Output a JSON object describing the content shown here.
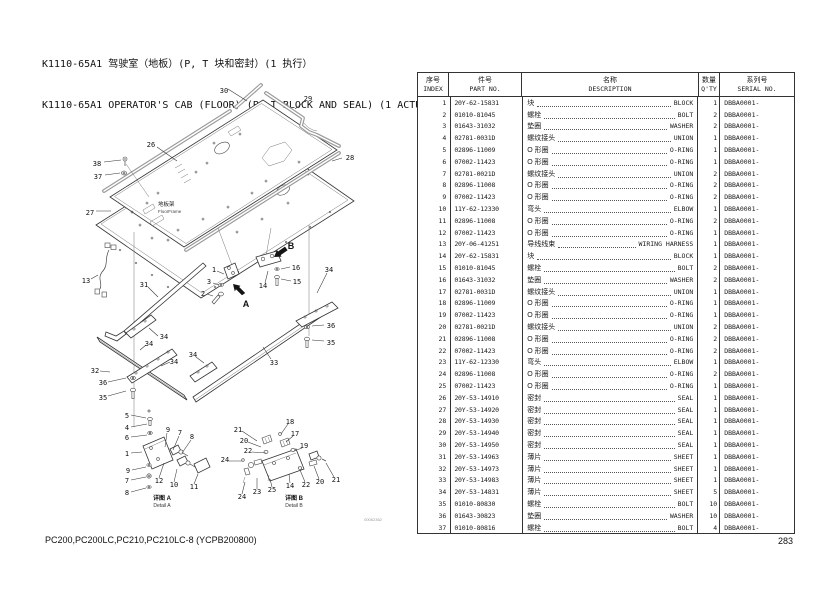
{
  "page": {
    "title_zh": "K1110-65A1 驾驶室（地板）(P, T 块和密封）(1 执行）",
    "title_en": "K1110-65A1 OPERATOR'S CAB (FLOOR) (P, T BLOCK AND SEAL) (1 ACTUATOR)",
    "footer_models": "PC200,PC200LC,PC210,PC210LC-8 (YCPB200800)",
    "page_number": "283"
  },
  "diagram": {
    "floor_frame_zh": "地板架",
    "floor_frame_en": "FloorFrame",
    "detail_a_zh": "详图 A",
    "detail_a_en": "Detail A",
    "detail_b_zh": "详图 B",
    "detail_b_en": "Detail B",
    "drawing_no": "00062362",
    "callouts": [
      {
        "t": "30",
        "x": 224,
        "y": 93
      },
      {
        "t": "29",
        "x": 308,
        "y": 101
      },
      {
        "t": "26",
        "x": 151,
        "y": 147
      },
      {
        "t": "28",
        "x": 350,
        "y": 160
      },
      {
        "t": "38",
        "x": 97,
        "y": 166
      },
      {
        "t": "37",
        "x": 98,
        "y": 179
      },
      {
        "t": "27",
        "x": 90,
        "y": 215
      },
      {
        "t": "13",
        "x": 86,
        "y": 283
      },
      {
        "t": "31",
        "x": 144,
        "y": 287
      },
      {
        "t": "1",
        "x": 214,
        "y": 272
      },
      {
        "t": "3",
        "x": 209,
        "y": 284
      },
      {
        "t": "2",
        "x": 203,
        "y": 296
      },
      {
        "t": "14",
        "x": 263,
        "y": 288
      },
      {
        "t": "16",
        "x": 296,
        "y": 270
      },
      {
        "t": "15",
        "x": 297,
        "y": 284
      },
      {
        "t": "34",
        "x": 329,
        "y": 272
      },
      {
        "t": "32",
        "x": 95,
        "y": 373
      },
      {
        "t": "36",
        "x": 103,
        "y": 385
      },
      {
        "t": "35",
        "x": 103,
        "y": 400
      },
      {
        "t": "34",
        "x": 164,
        "y": 339
      },
      {
        "t": "34",
        "x": 149,
        "y": 346
      },
      {
        "t": "34",
        "x": 174,
        "y": 364
      },
      {
        "t": "34",
        "x": 193,
        "y": 357
      },
      {
        "t": "33",
        "x": 274,
        "y": 365
      },
      {
        "t": "36",
        "x": 331,
        "y": 328
      },
      {
        "t": "35",
        "x": 331,
        "y": 345
      },
      {
        "t": "A",
        "x": 246,
        "y": 307,
        "big": true
      },
      {
        "t": "B",
        "x": 291,
        "y": 249,
        "big": true
      },
      {
        "t": "5",
        "x": 127,
        "y": 418
      },
      {
        "t": "4",
        "x": 127,
        "y": 430
      },
      {
        "t": "6",
        "x": 127,
        "y": 440
      },
      {
        "t": "1",
        "x": 127,
        "y": 456
      },
      {
        "t": "9",
        "x": 128,
        "y": 473
      },
      {
        "t": "7",
        "x": 127,
        "y": 483
      },
      {
        "t": "8",
        "x": 127,
        "y": 495
      },
      {
        "t": "9",
        "x": 168,
        "y": 432
      },
      {
        "t": "7",
        "x": 180,
        "y": 435
      },
      {
        "t": "8",
        "x": 192,
        "y": 439
      },
      {
        "t": "12",
        "x": 159,
        "y": 483
      },
      {
        "t": "10",
        "x": 174,
        "y": 487
      },
      {
        "t": "11",
        "x": 194,
        "y": 489
      },
      {
        "t": "21",
        "x": 238,
        "y": 432
      },
      {
        "t": "20",
        "x": 244,
        "y": 443
      },
      {
        "t": "22",
        "x": 248,
        "y": 453
      },
      {
        "t": "24",
        "x": 225,
        "y": 462
      },
      {
        "t": "18",
        "x": 290,
        "y": 424
      },
      {
        "t": "17",
        "x": 295,
        "y": 436
      },
      {
        "t": "19",
        "x": 304,
        "y": 448
      },
      {
        "t": "24",
        "x": 242,
        "y": 499
      },
      {
        "t": "23",
        "x": 257,
        "y": 494
      },
      {
        "t": "25",
        "x": 272,
        "y": 492
      },
      {
        "t": "14",
        "x": 290,
        "y": 488
      },
      {
        "t": "22",
        "x": 306,
        "y": 487
      },
      {
        "t": "20",
        "x": 320,
        "y": 484
      },
      {
        "t": "21",
        "x": 336,
        "y": 482
      }
    ]
  },
  "table": {
    "headers": [
      {
        "zh": "序号",
        "en": "INDEX"
      },
      {
        "zh": "件号",
        "en": "PART NO."
      },
      {
        "zh": "名称",
        "en": "DESCRIPTION"
      },
      {
        "zh": "数量",
        "en": "Q'TY"
      },
      {
        "zh": "系列号",
        "en": "SERIAL NO."
      }
    ],
    "rows": [
      [
        "1",
        "20Y-62-15831",
        "块",
        "BLOCK",
        "1",
        "DBBA0001-"
      ],
      [
        "2",
        "01010-81045",
        "螺栓",
        "BOLT",
        "2",
        "DBBA0001-"
      ],
      [
        "3",
        "01643-31032",
        "垫圈",
        "WASHER",
        "2",
        "DBBA0001-"
      ],
      [
        "4",
        "02781-0031D",
        "螺纹接头",
        "UNION",
        "1",
        "DBBA0001-"
      ],
      [
        "5",
        "02896-11009",
        "O 形圈",
        "O-RING",
        "1",
        "DBBA0001-"
      ],
      [
        "6",
        "07002-11423",
        "O 形圈",
        "O-RING",
        "1",
        "DBBA0001-"
      ],
      [
        "7",
        "02781-0021D",
        "螺纹接头",
        "UNION",
        "2",
        "DBBA0001-"
      ],
      [
        "8",
        "02896-11008",
        "O 形圈",
        "O-RING",
        "2",
        "DBBA0001-"
      ],
      [
        "9",
        "07002-11423",
        "O 形圈",
        "O-RING",
        "2",
        "DBBA0001-"
      ],
      [
        "10",
        "11Y-62-12330",
        "弯头",
        "ELBOW",
        "1",
        "DBBA0001-"
      ],
      [
        "11",
        "02896-11008",
        "O 形圈",
        "O-RING",
        "2",
        "DBBA0001-"
      ],
      [
        "12",
        "07002-11423",
        "O 形圈",
        "O-RING",
        "1",
        "DBBA0001-"
      ],
      [
        "13",
        "20Y-06-41251",
        "导线线束",
        "WIRING HARNESS",
        "1",
        "DBBA0001-"
      ],
      [
        "14",
        "20Y-62-15831",
        "块",
        "BLOCK",
        "1",
        "DBBA0001-"
      ],
      [
        "15",
        "01010-81045",
        "螺栓",
        "BOLT",
        "2",
        "DBBA0001-"
      ],
      [
        "16",
        "01643-31032",
        "垫圈",
        "WASHER",
        "2",
        "DBBA0001-"
      ],
      [
        "17",
        "02781-0031D",
        "螺纹接头",
        "UNION",
        "1",
        "DBBA0001-"
      ],
      [
        "18",
        "02896-11009",
        "O 形圈",
        "O-RING",
        "1",
        "DBBA0001-"
      ],
      [
        "19",
        "07002-11423",
        "O 形圈",
        "O-RING",
        "1",
        "DBBA0001-"
      ],
      [
        "20",
        "02781-0021D",
        "螺纹接头",
        "UNION",
        "2",
        "DBBA0001-"
      ],
      [
        "21",
        "02896-11008",
        "O 形圈",
        "O-RING",
        "2",
        "DBBA0001-"
      ],
      [
        "22",
        "07002-11423",
        "O 形圈",
        "O-RING",
        "2",
        "DBBA0001-"
      ],
      [
        "23",
        "11Y-62-12330",
        "弯头",
        "ELBOW",
        "1",
        "DBBA0001-"
      ],
      [
        "24",
        "02896-11008",
        "O 形圈",
        "O-RING",
        "2",
        "DBBA0001-"
      ],
      [
        "25",
        "07002-11423",
        "O 形圈",
        "O-RING",
        "1",
        "DBBA0001-"
      ],
      [
        "26",
        "20Y-53-14910",
        "密封",
        "SEAL",
        "1",
        "DBBA0001-"
      ],
      [
        "27",
        "20Y-53-14920",
        "密封",
        "SEAL",
        "1",
        "DBBA0001-"
      ],
      [
        "28",
        "20Y-53-14930",
        "密封",
        "SEAL",
        "1",
        "DBBA0001-"
      ],
      [
        "29",
        "20Y-53-14940",
        "密封",
        "SEAL",
        "1",
        "DBBA0001-"
      ],
      [
        "30",
        "20Y-53-14950",
        "密封",
        "SEAL",
        "1",
        "DBBA0001-"
      ],
      [
        "31",
        "20Y-53-14963",
        "薄片",
        "SHEET",
        "1",
        "DBBA0001-"
      ],
      [
        "32",
        "20Y-53-14973",
        "薄片",
        "SHEET",
        "1",
        "DBBA0001-"
      ],
      [
        "33",
        "20Y-53-14983",
        "薄片",
        "SHEET",
        "1",
        "DBBA0001-"
      ],
      [
        "34",
        "20Y-53-14831",
        "薄片",
        "SHEET",
        "5",
        "DBBA0001-"
      ],
      [
        "35",
        "01010-80830",
        "螺栓",
        "BOLT",
        "10",
        "DBBA0001-"
      ],
      [
        "36",
        "01643-30823",
        "垫圈",
        "WASHER",
        "10",
        "DBBA0001-"
      ],
      [
        "37",
        "01010-80816",
        "螺栓",
        "BOLT",
        "4",
        "DBBA0001-"
      ]
    ]
  }
}
